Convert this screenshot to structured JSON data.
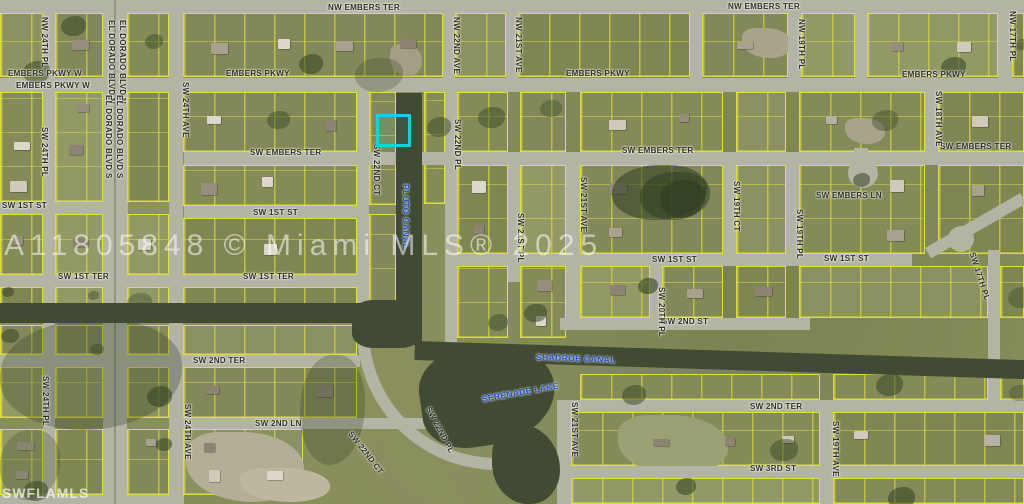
{
  "map": {
    "watermark_center": "A11805848 © Miami MLS® 2025",
    "watermark_corner": "SWFLAMLS",
    "colors": {
      "parcel_line": "#dede40",
      "highlight": "#15d2da",
      "water": "#414b34",
      "water_label": "#2050cc",
      "road": "#b4b4a5"
    },
    "highlighted_parcel": {
      "x": 376,
      "y": 114,
      "w": 29,
      "h": 27
    },
    "street_labels": [
      {
        "text": "NW EMBERS TER",
        "x": 328,
        "y": 3,
        "rot": 0
      },
      {
        "text": "NW EMBERS TER",
        "x": 728,
        "y": 2,
        "rot": 0
      },
      {
        "text": "EMBERS PKWY W",
        "x": 8,
        "y": 69,
        "rot": 0
      },
      {
        "text": "EMBERS PKWY W",
        "x": 16,
        "y": 81,
        "rot": 0
      },
      {
        "text": "EMBERS PKWY",
        "x": 226,
        "y": 69,
        "rot": 0
      },
      {
        "text": "EMBERS PKWY",
        "x": 566,
        "y": 69,
        "rot": 0
      },
      {
        "text": "EMBERS PKWY",
        "x": 902,
        "y": 70,
        "rot": 0
      },
      {
        "text": "SW EMBERS TER",
        "x": 250,
        "y": 148,
        "rot": 0
      },
      {
        "text": "SW EMBERS TER",
        "x": 622,
        "y": 146,
        "rot": 0
      },
      {
        "text": "SW EMBERS TER",
        "x": 940,
        "y": 142,
        "rot": 0
      },
      {
        "text": "SW EMBERS LN",
        "x": 816,
        "y": 191,
        "rot": 0
      },
      {
        "text": "SW 1ST ST",
        "x": 2,
        "y": 201,
        "rot": 0
      },
      {
        "text": "SW 1ST ST",
        "x": 253,
        "y": 208,
        "rot": 0
      },
      {
        "text": "SW 1ST ST",
        "x": 652,
        "y": 255,
        "rot": 0
      },
      {
        "text": "SW 1ST ST",
        "x": 824,
        "y": 254,
        "rot": 0
      },
      {
        "text": "SW 1ST TER",
        "x": 58,
        "y": 272,
        "rot": 0
      },
      {
        "text": "SW 1ST TER",
        "x": 243,
        "y": 272,
        "rot": 0
      },
      {
        "text": "SW 2ND ST",
        "x": 662,
        "y": 317,
        "rot": 0
      },
      {
        "text": "SW 2ND TER",
        "x": 193,
        "y": 356,
        "rot": 0
      },
      {
        "text": "SW 2ND TER",
        "x": 750,
        "y": 402,
        "rot": 0
      },
      {
        "text": "SW 2ND LN",
        "x": 255,
        "y": 419,
        "rot": 0
      },
      {
        "text": "SW 3RD ST",
        "x": 750,
        "y": 464,
        "rot": 0
      },
      {
        "text": "NW 24TH PL",
        "x": 40,
        "y": 17,
        "rot": 90
      },
      {
        "text": "EL DORADO BLVD N",
        "x": 107,
        "y": 20,
        "rot": 90
      },
      {
        "text": "EL DORADO BLVD N",
        "x": 118,
        "y": 20,
        "rot": 90
      },
      {
        "text": "EL DORADO BLVD S",
        "x": 104,
        "y": 95,
        "rot": 90
      },
      {
        "text": "EL DORADO BLVD S",
        "x": 115,
        "y": 95,
        "rot": 90
      },
      {
        "text": "SW 24TH PL",
        "x": 40,
        "y": 127,
        "rot": 90
      },
      {
        "text": "SW 24TH PL",
        "x": 41,
        "y": 376,
        "rot": 90
      },
      {
        "text": "SW 24TH AVE",
        "x": 181,
        "y": 82,
        "rot": 90
      },
      {
        "text": "SW 24TH AVE",
        "x": 183,
        "y": 404,
        "rot": 90
      },
      {
        "text": "NW 22ND AVE",
        "x": 452,
        "y": 17,
        "rot": 90
      },
      {
        "text": "NW 21ST AVE",
        "x": 514,
        "y": 17,
        "rot": 90
      },
      {
        "text": "NW 19TH PL",
        "x": 797,
        "y": 19,
        "rot": 90
      },
      {
        "text": "NW 17TH PL",
        "x": 1008,
        "y": 11,
        "rot": 90
      },
      {
        "text": "SW 18TH AVE",
        "x": 934,
        "y": 91,
        "rot": 90
      },
      {
        "text": "SW 22ND CT",
        "x": 372,
        "y": 144,
        "rot": 90
      },
      {
        "text": "SW 22ND PL",
        "x": 453,
        "y": 119,
        "rot": 90
      },
      {
        "text": "SW 21ST PL",
        "x": 516,
        "y": 213,
        "rot": 90
      },
      {
        "text": "SW 21ST AVE",
        "x": 579,
        "y": 177,
        "rot": 90
      },
      {
        "text": "SW 21ST AVE",
        "x": 570,
        "y": 402,
        "rot": 90
      },
      {
        "text": "SW 20TH PL",
        "x": 657,
        "y": 287,
        "rot": 90
      },
      {
        "text": "SW 19TH CT",
        "x": 732,
        "y": 181,
        "rot": 90
      },
      {
        "text": "SW 19TH PL",
        "x": 795,
        "y": 209,
        "rot": 90
      },
      {
        "text": "SW 19TH AVE",
        "x": 831,
        "y": 421,
        "rot": 90
      },
      {
        "text": "SW 22ND CT",
        "x": 350,
        "y": 428,
        "rot": 52
      },
      {
        "text": "SW 22ND PL",
        "x": 428,
        "y": 403,
        "rot": 62
      },
      {
        "text": "SW 17TH PL",
        "x": 972,
        "y": 248,
        "rot": 72
      }
    ],
    "water_labels": [
      {
        "text": "PLUTO CANAL",
        "x": 401,
        "y": 184,
        "rot": 90
      },
      {
        "text": "SHADROE CANAL",
        "x": 536,
        "y": 352,
        "rot": 2
      },
      {
        "text": "SERENADE LAKE",
        "x": 482,
        "y": 394,
        "rot": -10
      }
    ]
  }
}
